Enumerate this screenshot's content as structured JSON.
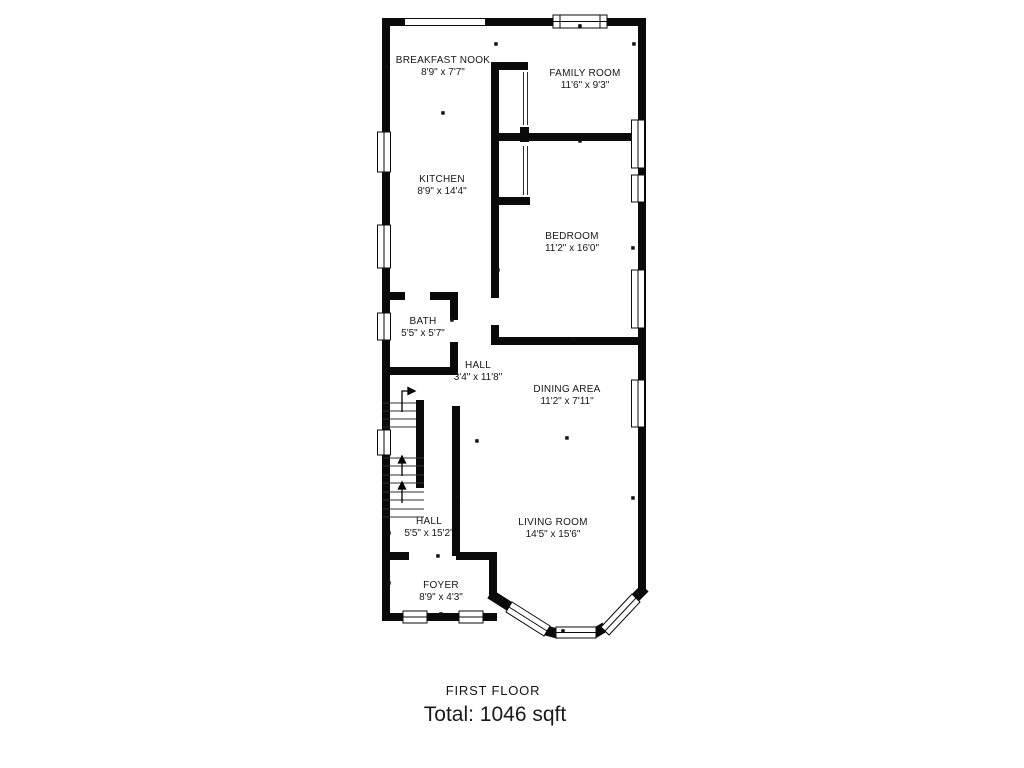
{
  "floorplan": {
    "floor_label": "FIRST FLOOR",
    "total_label": "Total: 1046 sqft",
    "total_sqft": 1046,
    "wall_color": "#000000",
    "background_color": "#ffffff",
    "rooms": [
      {
        "id": "breakfast-nook",
        "name": "BREAKFAST NOOK",
        "dims": "8'9\" x 7'7\""
      },
      {
        "id": "family-room",
        "name": "FAMILY ROOM",
        "dims": "11'6\" x 9'3\""
      },
      {
        "id": "kitchen",
        "name": "KITCHEN",
        "dims": "8'9\" x 14'4\""
      },
      {
        "id": "bedroom",
        "name": "BEDROOM",
        "dims": "11'2\" x 16'0\""
      },
      {
        "id": "bath",
        "name": "BATH",
        "dims": "5'5\" x 5'7\""
      },
      {
        "id": "hall-upper",
        "name": "HALL",
        "dims": "3'4\" x 11'8\""
      },
      {
        "id": "dining-area",
        "name": "DINING AREA",
        "dims": "11'2\" x 7'11\""
      },
      {
        "id": "hall-lower",
        "name": "HALL",
        "dims": "5'5\" x 15'2\""
      },
      {
        "id": "living-room",
        "name": "LIVING ROOM",
        "dims": "14'5\" x 15'6\""
      },
      {
        "id": "foyer",
        "name": "FOYER",
        "dims": "8'9\" x 4'3\""
      }
    ]
  }
}
